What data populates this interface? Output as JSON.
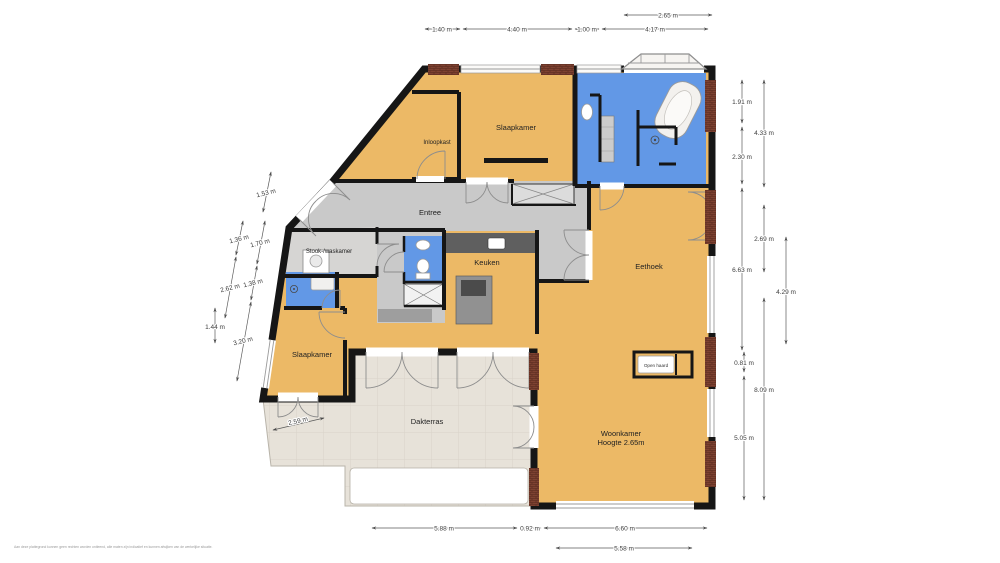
{
  "plan": {
    "rooms": {
      "inloopkast": {
        "label": "Inloopkast"
      },
      "slaapkamer_boven": {
        "label": "Slaapkamer"
      },
      "entree": {
        "label": "Entree"
      },
      "stook_waskamer": {
        "label": "Stook-/waskamer"
      },
      "keuken": {
        "label": "Keuken"
      },
      "eethoek": {
        "label": "Eethoek"
      },
      "slaapkamer_links": {
        "label": "Slaapkamer"
      },
      "woonkamer": {
        "label": "Woonkamer",
        "sublabel": "Hoogte 2.65m"
      },
      "open_haard": {
        "label": "Open haard"
      },
      "dakterras": {
        "label": "Dakterras"
      }
    },
    "dimensions": {
      "top": {
        "w265": "2.65 m",
        "w140": "1.40 m",
        "w440": "4.40 m",
        "w100": "1.00 m",
        "w417": "4.17 m"
      },
      "bottom": {
        "w588": "5.88 m",
        "w092": "0.92 m",
        "w660": "6.60 m",
        "w558": "5.58 m"
      },
      "right": {
        "w191": "1.91 m",
        "w230": "2.30 m",
        "w663": "6.63 m",
        "w081": "0.81 m",
        "w505": "5.05 m",
        "w433": "4.33 m",
        "w269": "2.69 m",
        "w809": "8.09 m",
        "w429": "4.29 m"
      },
      "left": {
        "w153": "1.53 m",
        "w136": "1.36 m",
        "w262": "2.62 m",
        "w170": "1.70 m",
        "w138": "1.38 m",
        "w320": "3.20 m",
        "w144": "1.44 m",
        "w259": "2.59 m"
      }
    },
    "colors": {
      "room_fill": "#ecb966",
      "wet_room_fill": "#6298e6",
      "hall_fill": "#c9c9c9",
      "utility_fill": "#d6d5d3",
      "terrace_fill": "#e7e2d9",
      "wall_color": "#161616",
      "masonry_color": "#7e4231"
    },
    "disclaimer": "Aan deze plattegrond kunnen geen rechten worden ontleend, alle maten zijn indicatief en kunnen afwijken van de werkelijke situatie."
  }
}
